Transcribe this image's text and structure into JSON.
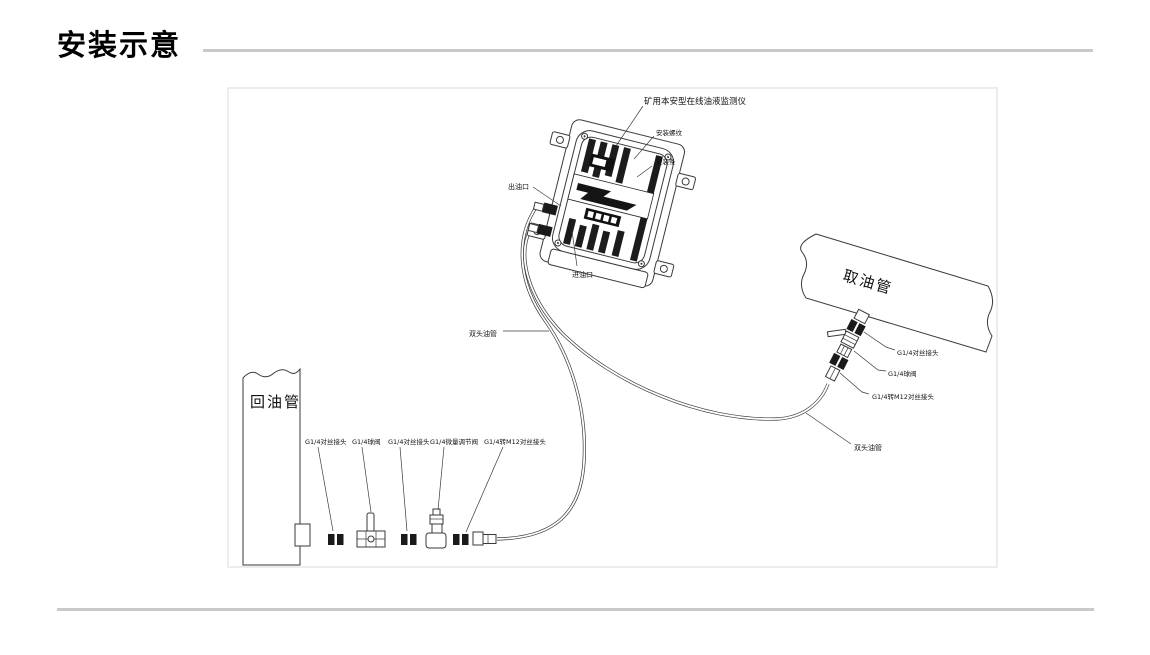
{
  "title": "安装示意",
  "diagram": {
    "device_label": "矿用本安型在线油液监测仪",
    "mount_thread_label": "安装螺纹",
    "mount_bar_label": "安装条",
    "outlet_label": "出油口",
    "inlet_label": "进油口",
    "tube_label": "双头油管",
    "intake_pipe_label": "取油管",
    "return_pipe_label": "回油管",
    "right_fittings": [
      "G1/4对丝接头",
      "G1/4球阀",
      "G1/4转M12对丝接头"
    ],
    "bottom_fittings": [
      "G1/4对丝接头",
      "G1/4球阀",
      "G1/4对丝接头",
      "G1/4微量调节阀",
      "G1/4转M12对丝接头"
    ],
    "colors": {
      "line": "#3a3a3a",
      "frame_border": "#ededed",
      "rule": "#c9c9c9",
      "text": "#111111"
    }
  }
}
